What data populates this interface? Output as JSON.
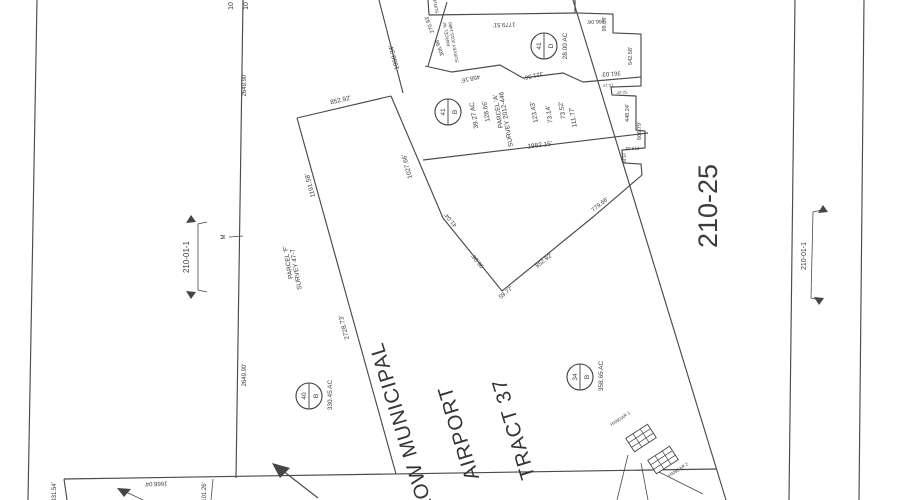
{
  "document": {
    "type": "assessor-parcel-survey-map",
    "ink_color": "#3c3c3c",
    "paper_color": "#ffffff"
  },
  "title": {
    "lines": [
      "LOW MUNICIPAL",
      "AIRPORT",
      "TRACT 37"
    ]
  },
  "sheet_number": "210-25",
  "adjacent_sheet_refs": [
    "210-01-1",
    "210-01-1"
  ],
  "parcel_circles": [
    {
      "number": "41",
      "letter": "D",
      "area": "28.00 AC"
    },
    {
      "number": "41",
      "letter": "B",
      "area": "39.27 AC"
    },
    {
      "number": "40",
      "letter": "B",
      "area": "330.45 AC"
    },
    {
      "number": "34",
      "letter": "B",
      "area": "358.65 AC"
    }
  ],
  "surveys": [
    {
      "name": "PARCEL 'F'",
      "ref": "SURVEY 47-7"
    },
    {
      "name": "PARCEL 'A'",
      "ref": "SURVEY 2012-446"
    },
    {
      "name": "PARCEL 'W'",
      "ref": "SURVEY 2015-1480"
    }
  ],
  "structures": [
    "HANGAR 1",
    "HANGAR 2"
  ],
  "labels": [
    {
      "t": "2649.90'",
      "x": 246,
      "y": 85,
      "r": -90,
      "s": 6
    },
    {
      "t": "2649.90'",
      "x": 246,
      "y": 375,
      "r": -90,
      "s": 6
    },
    {
      "t": "10",
      "x": 233,
      "y": 6,
      "r": -90,
      "s": 7
    },
    {
      "t": "10",
      "x": 248,
      "y": 6,
      "r": -90,
      "s": 7
    },
    {
      "t": "M",
      "x": 225,
      "y": 237,
      "r": -90,
      "s": 6
    },
    {
      "t": "210-01-1",
      "x": 189,
      "y": 257,
      "r": -90,
      "s": 8
    },
    {
      "t": "210-01-1",
      "x": 806,
      "y": 256,
      "r": -90,
      "s": 7
    },
    {
      "t": "210-25",
      "x": 717,
      "y": 206,
      "r": -90,
      "s": 27
    },
    {
      "t": "PARCEL 'F'",
      "x": 290,
      "y": 262,
      "r": -100,
      "s": 6.5
    },
    {
      "t": "SURVEY 47-7",
      "x": 298,
      "y": 269,
      "r": -100,
      "s": 6.5
    },
    {
      "t": "1191.58'",
      "x": 312,
      "y": 185,
      "r": -105,
      "s": 6.5
    },
    {
      "t": "2728.73'",
      "x": 346,
      "y": 327,
      "r": -105,
      "s": 6.5
    },
    {
      "t": "852.92'",
      "x": 341,
      "y": 102,
      "r": -13,
      "s": 6.5
    },
    {
      "t": "1027.66'",
      "x": 409,
      "y": 166,
      "r": -105,
      "s": 6.5
    },
    {
      "t": "1098.34'",
      "x": 396,
      "y": 57,
      "r": -105,
      "s": 6.5
    },
    {
      "t": "41.04'",
      "x": 452,
      "y": 219,
      "r": -129,
      "s": 6
    },
    {
      "t": "96.06'",
      "x": 479,
      "y": 260,
      "r": -129,
      "s": 6
    },
    {
      "t": "59.77'",
      "x": 507,
      "y": 294,
      "r": -39,
      "s": 6
    },
    {
      "t": "852.92'",
      "x": 545,
      "y": 262,
      "r": -39,
      "s": 6
    },
    {
      "t": "779.66'",
      "x": 601,
      "y": 206,
      "r": -39,
      "s": 6
    },
    {
      "t": "458.16'",
      "x": 470,
      "y": 77,
      "r": 167,
      "s": 6
    },
    {
      "t": "321.36'",
      "x": 533,
      "y": 74,
      "r": 167,
      "s": 6
    },
    {
      "t": "361.03'",
      "x": 611,
      "y": 72,
      "r": 176,
      "s": 6
    },
    {
      "t": "1779.51'",
      "x": 504,
      "y": 23,
      "r": 178,
      "s": 6
    },
    {
      "t": "270.93'",
      "x": 431,
      "y": 24,
      "r": -110,
      "s": 5.5
    },
    {
      "t": "306.98'",
      "x": 441,
      "y": 47,
      "r": -110,
      "s": 5.5
    },
    {
      "t": "PARCEL 'W'",
      "x": 448,
      "y": 34,
      "r": -100,
      "s": 4.5
    },
    {
      "t": "SURVEY 2015-1480",
      "x": 455,
      "y": 42,
      "r": -100,
      "s": 4.5
    },
    {
      "t": "SURVEY",
      "x": 437,
      "y": 4,
      "r": -100,
      "s": 4.5
    },
    {
      "t": "39.27 AC",
      "x": 476,
      "y": 115,
      "r": -100,
      "s": 6.5
    },
    {
      "t": "128.66'",
      "x": 488,
      "y": 111,
      "r": -100,
      "s": 6.5
    },
    {
      "t": "PARCEL 'A'",
      "x": 500,
      "y": 111,
      "r": -100,
      "s": 6.5
    },
    {
      "t": "SURVEY 2012-446",
      "x": 508,
      "y": 119,
      "r": -100,
      "s": 6.5
    },
    {
      "t": "123.43'",
      "x": 536,
      "y": 112,
      "r": -100,
      "s": 6.5
    },
    {
      "t": "73.14'",
      "x": 551,
      "y": 114,
      "r": -100,
      "s": 6.5
    },
    {
      "t": "73.52'",
      "x": 564,
      "y": 110,
      "r": -100,
      "s": 6.5
    },
    {
      "t": "111.77'",
      "x": 575,
      "y": 117,
      "r": -100,
      "s": 6.5
    },
    {
      "t": "1982.15'",
      "x": 540,
      "y": 147,
      "r": -7,
      "s": 6.5
    },
    {
      "t": "166.06'",
      "x": 596,
      "y": 20,
      "r": 178,
      "s": 5.5
    },
    {
      "t": "99.09'",
      "x": 606,
      "y": 24,
      "r": -90,
      "s": 5.5
    },
    {
      "t": "542.58'",
      "x": 632,
      "y": 56,
      "r": -90,
      "s": 5.5
    },
    {
      "t": "13.13'",
      "x": 608,
      "y": 84,
      "r": 178,
      "s": 4
    },
    {
      "t": "52.19'",
      "x": 622,
      "y": 91,
      "r": 178,
      "s": 4
    },
    {
      "t": "448.24'",
      "x": 629,
      "y": 113,
      "r": -90,
      "s": 5.5
    },
    {
      "t": "666.79'",
      "x": 641,
      "y": 131,
      "r": -90,
      "s": 5.5
    },
    {
      "t": "219.53'",
      "x": 632,
      "y": 147,
      "r": 178,
      "s": 4.5
    },
    {
      "t": "84.16'",
      "x": 626,
      "y": 158,
      "r": -90,
      "s": 4
    },
    {
      "t": "1668.04'",
      "x": 156,
      "y": 482,
      "r": 178,
      "s": 6
    },
    {
      "t": "331.54'",
      "x": 56,
      "y": 492,
      "r": -90,
      "s": 6
    },
    {
      "t": "101.26'",
      "x": 206,
      "y": 492,
      "r": -90,
      "s": 6
    },
    {
      "t": "HANGAR 1",
      "x": 621,
      "y": 420,
      "r": -33,
      "s": 4.5
    },
    {
      "t": "HANGAR 2",
      "x": 679,
      "y": 471,
      "r": -33,
      "s": 4.5
    },
    {
      "t": "28.00 AC",
      "x": 567,
      "y": 46,
      "r": -90,
      "s": 6.5
    },
    {
      "t": "330.45 AC",
      "x": 332,
      "y": 395,
      "r": -90,
      "s": 6.5
    },
    {
      "t": "358.65 AC",
      "x": 603,
      "y": 376,
      "r": -90,
      "s": 6.5
    }
  ]
}
